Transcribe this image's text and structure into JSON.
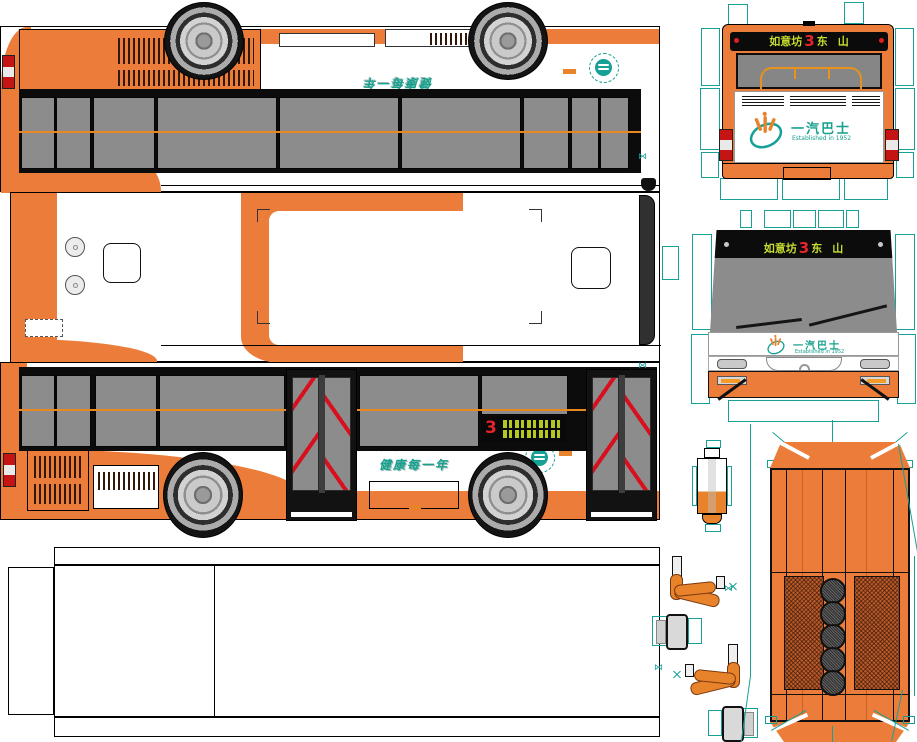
{
  "title": "一汽巴士 bus papercraft cutout sheet",
  "signs": {
    "destination": {
      "origin": "如意坊",
      "route": "3",
      "dest_a": "东",
      "dest_b": "山"
    },
    "side_route": "3"
  },
  "brand": {
    "name": "一汽巴士",
    "established": "Established in 1952"
  },
  "slogan": {
    "line1": "环保每一天",
    "line2": "健康每一年"
  },
  "icons": {
    "registration_mark": "⋈"
  },
  "colors": {
    "body_orange": "#EC7C39",
    "rub_rail_orange": "#E8881E",
    "cutline_teal": "#17A096",
    "brand_teal": "#16A08D",
    "chevron_red": "#D8101E",
    "route_red": "#E3242C",
    "sign_text_green": "#C8DC30",
    "led_green": "#B5C81E",
    "window_gray": "#8C8C8C"
  }
}
